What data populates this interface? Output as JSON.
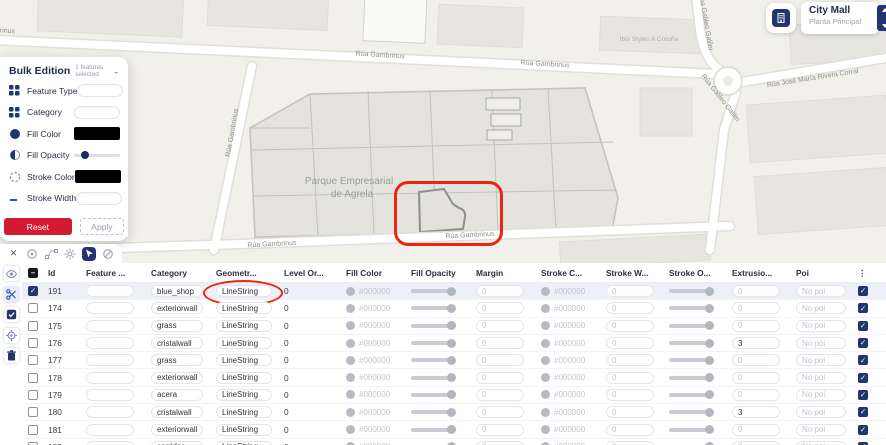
{
  "map": {
    "labels": [
      {
        "text": "Rúa Gambrinus",
        "kind": "street"
      },
      {
        "text": "Rúa Gambrinus",
        "kind": "street"
      },
      {
        "text": "Rúa Gambrinus",
        "kind": "street"
      },
      {
        "text": "Rúa Gambrinus",
        "kind": "street"
      },
      {
        "text": "Rúa Gambrinus",
        "kind": "street"
      },
      {
        "text": "Rúa Gambrinus",
        "kind": "street"
      },
      {
        "text": "Rúa Galileo Galilei",
        "kind": "street"
      },
      {
        "text": "Rúa Galileo Galilei",
        "kind": "street"
      },
      {
        "text": "Rúa José María Rivera Corral",
        "kind": "street"
      },
      {
        "text": "Ibis Styles A Coruña",
        "kind": "poi"
      },
      {
        "text": "Parque Empresarial",
        "kind": "area"
      },
      {
        "text": "de Agrela",
        "kind": "area"
      }
    ]
  },
  "mall_card": {
    "title": "City Mall",
    "subtitle": "Planta Principal",
    "icon": "building-icon"
  },
  "bulk_panel": {
    "title": "Bulk Edition",
    "selection": "1 features selected",
    "fields": [
      {
        "label": "Feature Type",
        "icon": "grid-icon",
        "control": "input",
        "value": ""
      },
      {
        "label": "Category",
        "icon": "grid-icon",
        "control": "input",
        "value": ""
      },
      {
        "label": "Fill Color",
        "icon": "filled-circle-icon",
        "control": "swatch",
        "value": "#000000"
      },
      {
        "label": "Fill Opacity",
        "icon": "half-circle-icon",
        "control": "slider",
        "value": 15
      },
      {
        "label": "Stroke Color",
        "icon": "dashed-circle-icon",
        "control": "swatch",
        "value": "#000000"
      },
      {
        "label": "Stroke Width",
        "icon": "line-icon",
        "control": "input",
        "value": ""
      },
      {
        "label": "Stroke Opacity",
        "icon": "corner-icon",
        "control": "slider",
        "value": 15
      }
    ],
    "reset_label": "Reset",
    "apply_label": "Apply"
  },
  "toolbar": {
    "close": "✕",
    "tools": [
      {
        "name": "target-tool-icon",
        "active": false
      },
      {
        "name": "route-tool-icon",
        "active": false
      },
      {
        "name": "settings-icon",
        "active": false
      },
      {
        "name": "select-tool-icon",
        "active": true
      },
      {
        "name": "slash-tool-icon",
        "active": false
      }
    ]
  },
  "rail": [
    {
      "name": "visibility-icon",
      "highlight": false
    },
    {
      "name": "cut-icon",
      "highlight": true
    },
    {
      "name": "multiselect-icon",
      "highlight": false
    },
    {
      "name": "locate-icon",
      "highlight": false
    },
    {
      "name": "delete-icon",
      "highlight": false
    }
  ],
  "table": {
    "columns": [
      {
        "key": "id",
        "label": "Id"
      },
      {
        "key": "feature",
        "label": "Feature ..."
      },
      {
        "key": "category",
        "label": "Category"
      },
      {
        "key": "geometry",
        "label": "Geometr..."
      },
      {
        "key": "level_order",
        "label": "Level Or..."
      },
      {
        "key": "fill_color",
        "label": "Fill Color"
      },
      {
        "key": "fill_opacity",
        "label": "Fill Opacity"
      },
      {
        "key": "margin",
        "label": "Margin"
      },
      {
        "key": "stroke_color",
        "label": "Stroke C..."
      },
      {
        "key": "stroke_width",
        "label": "Stroke W..."
      },
      {
        "key": "stroke_opacity",
        "label": "Stroke O..."
      },
      {
        "key": "extrusion",
        "label": "Extrusio..."
      },
      {
        "key": "poi",
        "label": "Poi"
      },
      {
        "key": "menu",
        "label": "⋮"
      }
    ],
    "rows": [
      {
        "id": "191",
        "feature": "",
        "category": "blue_shop",
        "geometry": "LineString",
        "level_order": "0",
        "fill_color": "#000000",
        "fill_opacity": 82,
        "margin": "0",
        "stroke_color": "#000000",
        "stroke_width": "0",
        "stroke_opacity": 82,
        "extrusion": "0",
        "poi": "No poi",
        "checked": true,
        "end_checked": true,
        "selected": true,
        "geometry_annotated": true
      },
      {
        "id": "174",
        "feature": "",
        "category": "exteriorwall",
        "geometry": "LineString",
        "level_order": "0",
        "fill_color": "#000000",
        "fill_opacity": 82,
        "margin": "0",
        "stroke_color": "#000000",
        "stroke_width": "0",
        "stroke_opacity": 82,
        "extrusion": "0",
        "poi": "No poi",
        "checked": false,
        "end_checked": true,
        "selected": false,
        "geometry_annotated": false
      },
      {
        "id": "175",
        "feature": "",
        "category": "grass",
        "geometry": "LineString",
        "level_order": "0",
        "fill_color": "#000000",
        "fill_opacity": 82,
        "margin": "0",
        "stroke_color": "#000000",
        "stroke_width": "0",
        "stroke_opacity": 82,
        "extrusion": "0",
        "poi": "No poi",
        "checked": false,
        "end_checked": true,
        "selected": false,
        "geometry_annotated": false
      },
      {
        "id": "176",
        "feature": "",
        "category": "cristalwall",
        "geometry": "LineString",
        "level_order": "0",
        "fill_color": "#000000",
        "fill_opacity": 82,
        "margin": "0",
        "stroke_color": "#000000",
        "stroke_width": "0",
        "stroke_opacity": 82,
        "extrusion": "3",
        "poi": "No poi",
        "checked": false,
        "end_checked": true,
        "selected": false,
        "geometry_annotated": false
      },
      {
        "id": "177",
        "feature": "",
        "category": "grass",
        "geometry": "LineString",
        "level_order": "0",
        "fill_color": "#000000",
        "fill_opacity": 82,
        "margin": "0",
        "stroke_color": "#000000",
        "stroke_width": "0",
        "stroke_opacity": 82,
        "extrusion": "0",
        "poi": "No poi",
        "checked": false,
        "end_checked": true,
        "selected": false,
        "geometry_annotated": false
      },
      {
        "id": "178",
        "feature": "",
        "category": "exteriorwall",
        "geometry": "LineString",
        "level_order": "0",
        "fill_color": "#000000",
        "fill_opacity": 82,
        "margin": "0",
        "stroke_color": "#000000",
        "stroke_width": "0",
        "stroke_opacity": 82,
        "extrusion": "0",
        "poi": "No poi",
        "checked": false,
        "end_checked": true,
        "selected": false,
        "geometry_annotated": false
      },
      {
        "id": "179",
        "feature": "",
        "category": "acera",
        "geometry": "LineString",
        "level_order": "0",
        "fill_color": "#000000",
        "fill_opacity": 82,
        "margin": "0",
        "stroke_color": "#000000",
        "stroke_width": "0",
        "stroke_opacity": 82,
        "extrusion": "0",
        "poi": "No poi",
        "checked": false,
        "end_checked": true,
        "selected": false,
        "geometry_annotated": false
      },
      {
        "id": "180",
        "feature": "",
        "category": "cristalwall",
        "geometry": "LineString",
        "level_order": "0",
        "fill_color": "#000000",
        "fill_opacity": 82,
        "margin": "0",
        "stroke_color": "#000000",
        "stroke_width": "0",
        "stroke_opacity": 82,
        "extrusion": "3",
        "poi": "No poi",
        "checked": false,
        "end_checked": true,
        "selected": false,
        "geometry_annotated": false
      },
      {
        "id": "181",
        "feature": "",
        "category": "exteriorwall",
        "geometry": "LineString",
        "level_order": "0",
        "fill_color": "#000000",
        "fill_opacity": 82,
        "margin": "0",
        "stroke_color": "#000000",
        "stroke_width": "0",
        "stroke_opacity": 82,
        "extrusion": "0",
        "poi": "No poi",
        "checked": false,
        "end_checked": true,
        "selected": false,
        "geometry_annotated": false
      },
      {
        "id": "182",
        "feature": "",
        "category": "corridor",
        "geometry": "LineString",
        "level_order": "0",
        "fill_color": "#000000",
        "fill_opacity": 82,
        "margin": "0",
        "stroke_color": "#000000",
        "stroke_width": "0",
        "stroke_opacity": 82,
        "extrusion": "0",
        "poi": "No poi",
        "checked": false,
        "end_checked": true,
        "selected": false,
        "geometry_annotated": false
      }
    ]
  },
  "colors": {
    "accent_navy": "#22356f",
    "accent_red": "#d41a31",
    "annotation_red": "#e8270e"
  }
}
